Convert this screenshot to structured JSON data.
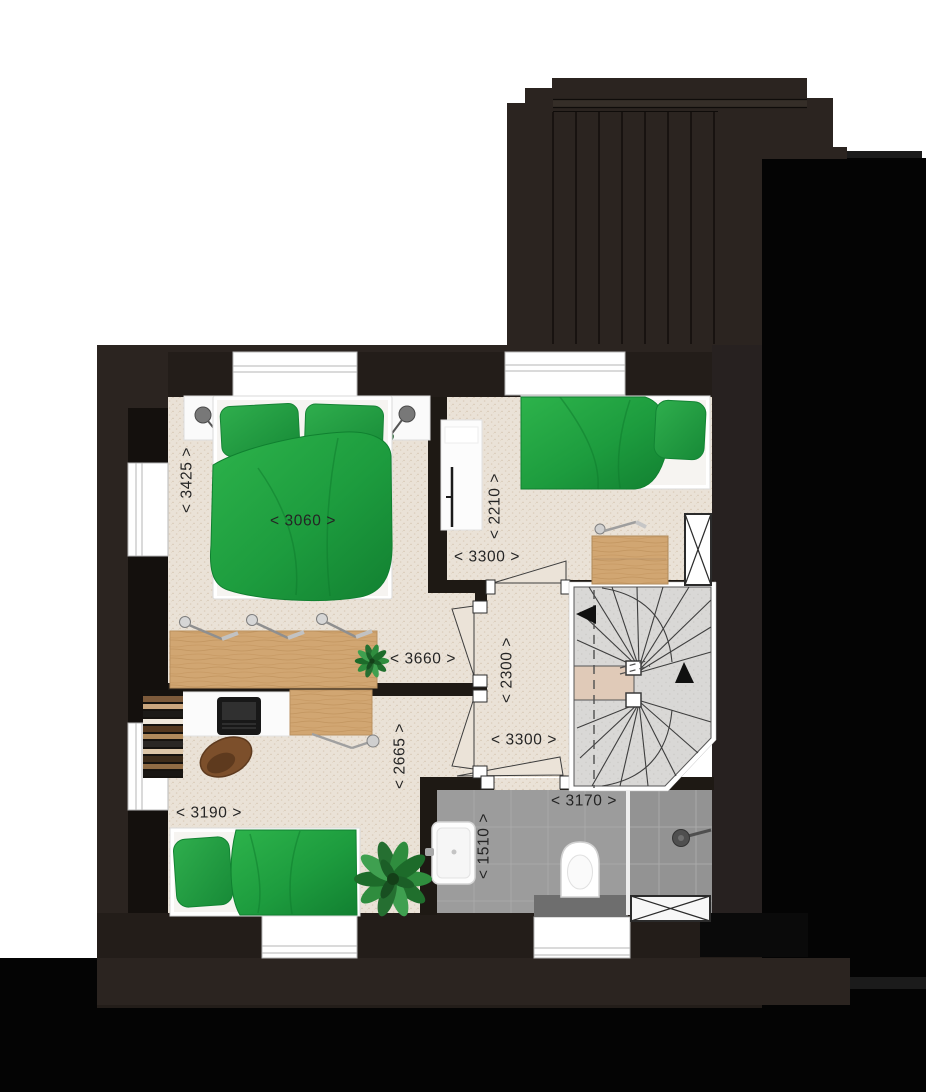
{
  "type": "architectural-floor-plan",
  "dimension_labels": {
    "bedroom1_depth": "< 3425 >",
    "bedroom1_bed_width": "< 3060 >",
    "bedroom1_width": "< 3660 >",
    "bedroom2_depth": "< 2210 >",
    "bedroom2_width": "< 3300 >",
    "hall_depth": "< 2300 >",
    "hall_width": "< 3300 >",
    "bedroom3_depth": "< 2665 >",
    "bedroom3_width": "< 3190 >",
    "bathroom_width": "< 3170 >",
    "bathroom_depth": "< 1510 >"
  },
  "rooms": [
    {
      "id": "bedroom-1",
      "furniture": [
        "double-bed",
        "nightstand",
        "nightstand",
        "bedside-lamp",
        "bedside-lamp",
        "long-desk",
        "desk-lamps",
        "plant"
      ]
    },
    {
      "id": "bedroom-2",
      "furniture": [
        "single-bed",
        "pillow",
        "desk",
        "monitor",
        "dresser",
        "desk-lamp",
        "wardrobe-crosshatch"
      ]
    },
    {
      "id": "hall-landing",
      "furniture": []
    },
    {
      "id": "bedroom-3",
      "furniture": [
        "single-bed",
        "pillow",
        "desk",
        "laptop",
        "chair",
        "bookshelf",
        "plant",
        "desk-lamp"
      ]
    },
    {
      "id": "bathroom",
      "furniture": [
        "sink",
        "toilet",
        "shower",
        "glass-partition",
        "crosshatch-vent"
      ]
    }
  ],
  "stairs": {
    "type": "winder-staircase",
    "arrows": [
      "left",
      "up"
    ],
    "has_dashed_headroom_line": true
  },
  "windows": 6,
  "doors": 4,
  "colors": {
    "background": "#ffffff",
    "backdrop_black": "#040404",
    "wall": "#231d19",
    "wall_outer": "#2b2420",
    "roof": "#2b2420",
    "floor_carpet": "#eae2d7",
    "bathroom_tile": "#9c9c9c",
    "stair_tread": "#d9d8d6",
    "stair_landing": "#e0cab8",
    "duvet_green": "#1d9c3e",
    "wood": "#d1a672",
    "label_text": "#242424"
  }
}
